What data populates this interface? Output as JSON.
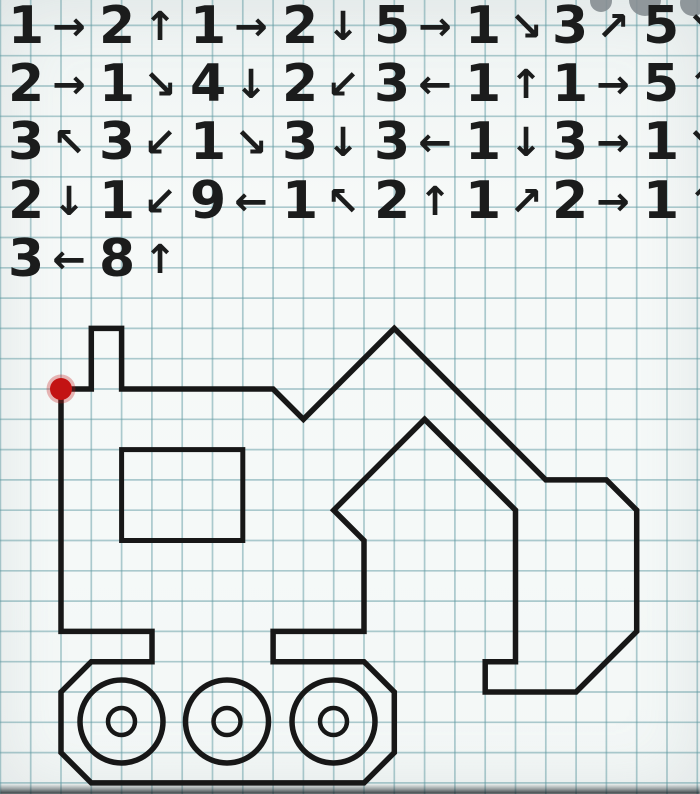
{
  "page": {
    "width": 700,
    "height": 794
  },
  "grid": {
    "cell": 30.3,
    "offset_x": 0.4,
    "offset_y": 25.4,
    "line_color": "#5f99a1",
    "line_opacity": 0.5,
    "line_width": 1.7
  },
  "instructions": {
    "column_x": [
      8,
      99,
      190,
      282,
      374,
      465,
      552,
      643
    ],
    "row_y": [
      26,
      84,
      142,
      201,
      259
    ],
    "rows": [
      [
        {
          "n": "1",
          "dir": "right",
          "arrow": "→"
        },
        {
          "n": "2",
          "dir": "up",
          "arrow": "↑"
        },
        {
          "n": "1",
          "dir": "right",
          "arrow": "→"
        },
        {
          "n": "2",
          "dir": "down",
          "arrow": "↓"
        },
        {
          "n": "5",
          "dir": "right",
          "arrow": "→"
        },
        {
          "n": "1",
          "dir": "down-right",
          "arrow": "↘"
        },
        {
          "n": "3",
          "dir": "up-right",
          "arrow": "↗"
        },
        {
          "n": "5",
          "dir": "down-right",
          "arrow": "↘"
        }
      ],
      [
        {
          "n": "2",
          "dir": "right",
          "arrow": "→"
        },
        {
          "n": "1",
          "dir": "down-right",
          "arrow": "↘"
        },
        {
          "n": "4",
          "dir": "down",
          "arrow": "↓"
        },
        {
          "n": "2",
          "dir": "down-left",
          "arrow": "↙"
        },
        {
          "n": "3",
          "dir": "left",
          "arrow": "←"
        },
        {
          "n": "1",
          "dir": "up",
          "arrow": "↑"
        },
        {
          "n": "1",
          "dir": "right",
          "arrow": "→"
        },
        {
          "n": "5",
          "dir": "up",
          "arrow": "↑"
        }
      ],
      [
        {
          "n": "3",
          "dir": "up-left",
          "arrow": "↖"
        },
        {
          "n": "3",
          "dir": "down-left",
          "arrow": "↙"
        },
        {
          "n": "1",
          "dir": "down-right",
          "arrow": "↘"
        },
        {
          "n": "3",
          "dir": "down",
          "arrow": "↓"
        },
        {
          "n": "3",
          "dir": "left",
          "arrow": "←"
        },
        {
          "n": "1",
          "dir": "down",
          "arrow": "↓"
        },
        {
          "n": "3",
          "dir": "right",
          "arrow": "→"
        },
        {
          "n": "1",
          "dir": "down-right",
          "arrow": "↘"
        }
      ],
      [
        {
          "n": "2",
          "dir": "down",
          "arrow": "↓"
        },
        {
          "n": "1",
          "dir": "down-left",
          "arrow": "↙"
        },
        {
          "n": "9",
          "dir": "left",
          "arrow": "←"
        },
        {
          "n": "1",
          "dir": "up-left",
          "arrow": "↖"
        },
        {
          "n": "2",
          "dir": "up",
          "arrow": "↑"
        },
        {
          "n": "1",
          "dir": "up-right",
          "arrow": "↗"
        },
        {
          "n": "2",
          "dir": "right",
          "arrow": "→"
        },
        {
          "n": "1",
          "dir": "up",
          "arrow": "↑"
        }
      ],
      [
        {
          "n": "3",
          "dir": "left",
          "arrow": "←"
        },
        {
          "n": "8",
          "dir": "up",
          "arrow": "↑"
        }
      ]
    ]
  },
  "figure": {
    "stroke": "#171717",
    "stroke_width": 5.5,
    "outline": [
      [
        61.0,
        389.0
      ],
      [
        91.3,
        389.0
      ],
      [
        91.3,
        328.4
      ],
      [
        121.6,
        328.4
      ],
      [
        121.6,
        389.0
      ],
      [
        273.1,
        389.0
      ],
      [
        303.4,
        419.3
      ],
      [
        394.3,
        328.4
      ],
      [
        545.8,
        479.9
      ],
      [
        606.4,
        479.9
      ],
      [
        636.7,
        510.2
      ],
      [
        636.7,
        631.4
      ],
      [
        576.1,
        692.0
      ],
      [
        485.2,
        692.0
      ],
      [
        485.2,
        661.7
      ],
      [
        515.5,
        661.7
      ],
      [
        515.5,
        510.2
      ],
      [
        424.6,
        419.3
      ],
      [
        333.7,
        510.2
      ],
      [
        364.0,
        540.5
      ],
      [
        364.0,
        631.4
      ],
      [
        273.1,
        631.4
      ],
      [
        273.1,
        661.7
      ],
      [
        364.0,
        661.7
      ],
      [
        394.3,
        692.0
      ],
      [
        394.3,
        752.6
      ],
      [
        364.0,
        782.9
      ],
      [
        91.3,
        782.9
      ],
      [
        61.0,
        752.6
      ],
      [
        61.0,
        692.0
      ],
      [
        91.3,
        661.7
      ],
      [
        152.0,
        661.7
      ],
      [
        152.0,
        631.4
      ],
      [
        61.0,
        631.4
      ]
    ],
    "window": {
      "x": 121.6,
      "y": 449.6,
      "w": 121.2,
      "h": 90.9
    },
    "wheels": {
      "centers": [
        [
          121.5,
          721.5
        ],
        [
          227.0,
          721.5
        ],
        [
          333.5,
          721.5
        ]
      ],
      "outer_r": 41.5,
      "inner_r": 13.5
    },
    "start_dot": {
      "x": 61,
      "y": 389,
      "r": 11,
      "color": "#c31313"
    }
  },
  "artifacts": {
    "blob_color": "#868e92",
    "blobs": [
      {
        "x": 601,
        "y": 1,
        "r": 11
      },
      {
        "x": 645,
        "y": 0,
        "r": 16
      },
      {
        "x": 693,
        "y": 3,
        "r": 13
      }
    ]
  }
}
